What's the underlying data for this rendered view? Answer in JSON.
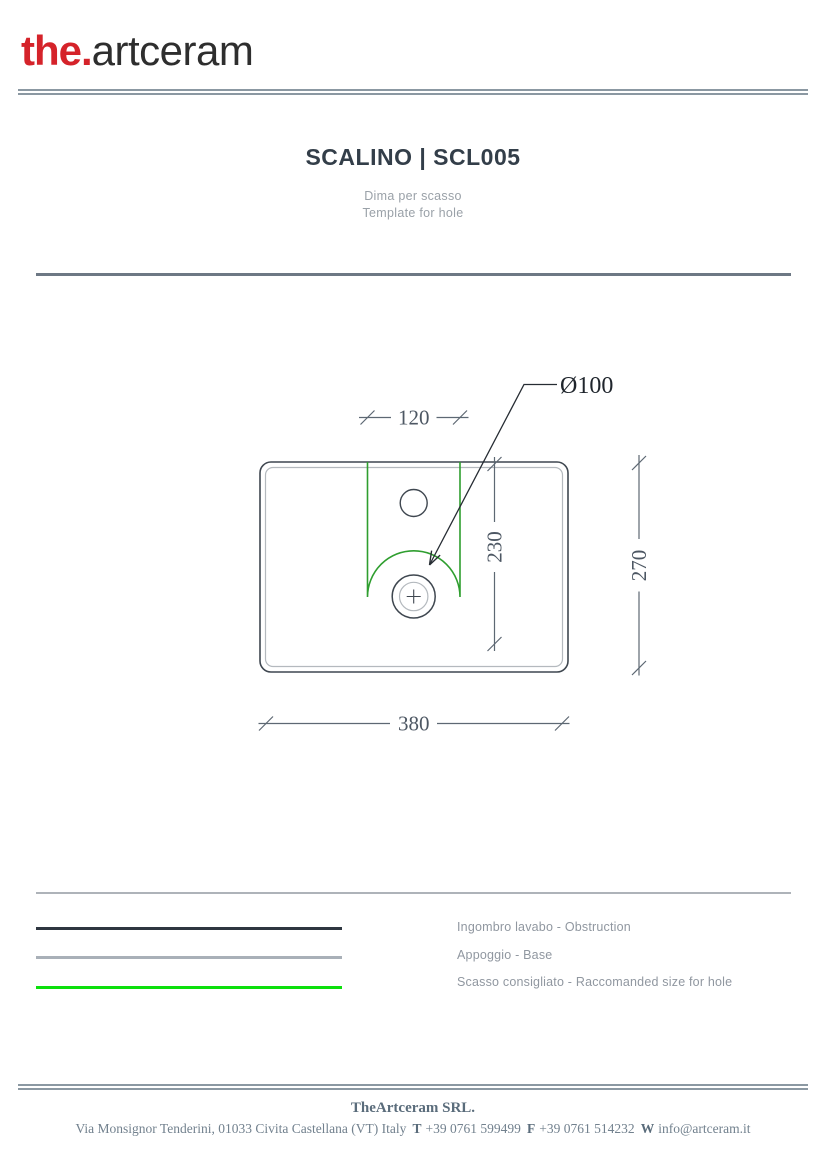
{
  "brand": {
    "logo_the": "the.",
    "logo_rest": "artceram",
    "logo_red": "#d5232a",
    "logo_dark": "#2e2e2e"
  },
  "header": {
    "title": "SCALINO | SCL005",
    "subtitle_it": "Dima per scasso",
    "subtitle_en": "Template for hole"
  },
  "drawing": {
    "dims": {
      "hole_width": "120",
      "hole_depth": "230",
      "basin_depth": "270",
      "basin_width": "380",
      "drain_diameter": "Ø100"
    },
    "colors": {
      "outline": "#3f4750",
      "base": "#b4b9be",
      "hole": "#2f9e2f",
      "dimension": "#5d6873",
      "leader": "#262c33"
    }
  },
  "legend": {
    "items": [
      {
        "label": "Ingombro lavabo - Obstruction",
        "color": "#2e3640"
      },
      {
        "label": "Appoggio - Base",
        "color": "#a9b0b8"
      },
      {
        "label": "Scasso consigliato - Raccomanded size for hole",
        "color": "#0ce00c"
      }
    ]
  },
  "footer": {
    "company": "TheArtceram SRL.",
    "address": "Via Monsignor Tenderini, 01033 Civita Castellana (VT) Italy",
    "phone_label": "T",
    "phone": "+39 0761 599499",
    "fax_label": "F",
    "fax": "+39 0761 514232",
    "web_label": "W",
    "email": "info@artceram.it"
  }
}
